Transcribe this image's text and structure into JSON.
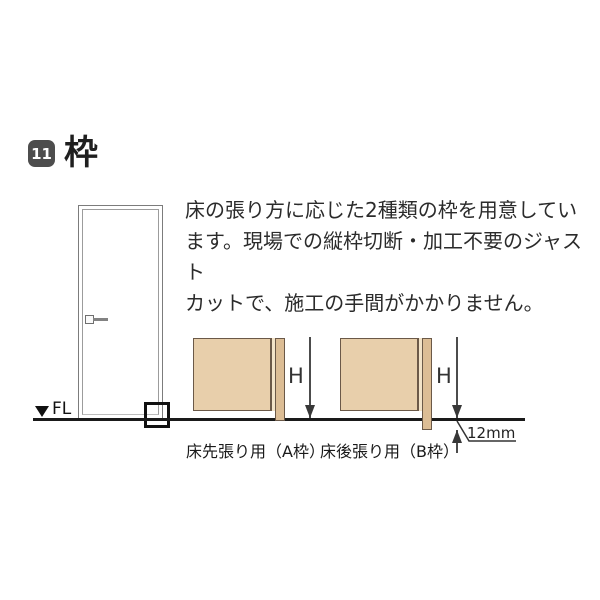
{
  "header": {
    "number": "11",
    "title": "枠"
  },
  "intro": {
    "lines": [
      "床の張り方に応じた2種類の枠を用意してい",
      "ます。現場での縦枠切断・加工不要のジャスト",
      "カットで、施工の手間がかかりません。"
    ]
  },
  "door_elevation": {
    "fl_label": "FL"
  },
  "diagrams": {
    "a": {
      "caption": "床先張り用（A枠）",
      "dim_label": "H"
    },
    "b": {
      "caption": "床後張り用（B枠）",
      "dim_label": "H",
      "offset_label": "12mm"
    }
  },
  "colors": {
    "wall_fill": "#e8cfab",
    "frame_fill": "#dcbd95",
    "outline": "#6b5948",
    "floor_line": "#1a1a1a",
    "badge_bg": "#4d4d4d",
    "text": "#2b2b2b"
  }
}
